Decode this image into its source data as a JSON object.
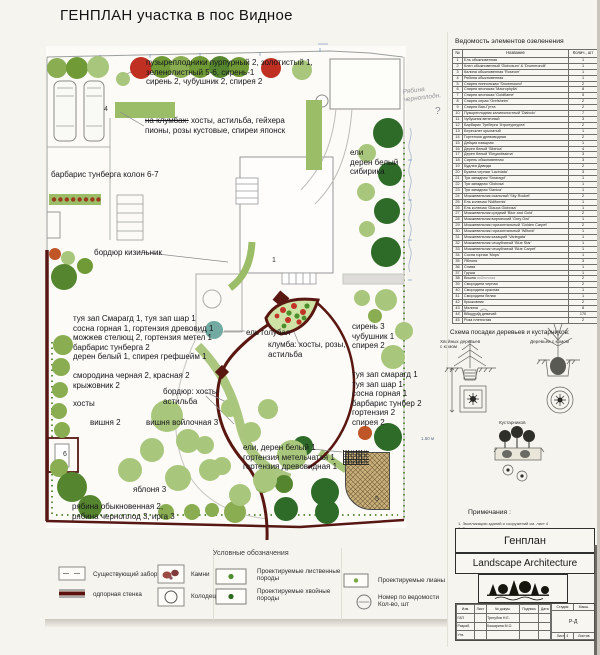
{
  "page": {
    "title": "ГЕНПЛАН участка в пос Видное"
  },
  "plan": {
    "tree_colors": {
      "l": "#a9c77c",
      "m": "#8aad52",
      "g": "#6f9a35",
      "d": "#55862f",
      "e": "#2e6b28",
      "r": "#bf2f22",
      "o": "#c05627",
      "t": "#72aaa2"
    },
    "trees": [
      [
        57,
        68,
        10,
        "m"
      ],
      [
        77,
        68,
        11,
        "g"
      ],
      [
        98,
        67,
        11,
        "l"
      ],
      [
        123,
        79,
        7,
        "l"
      ],
      [
        141,
        68,
        11,
        "r"
      ],
      [
        162,
        67,
        11,
        "g"
      ],
      [
        181,
        67,
        11,
        "m"
      ],
      [
        200,
        67,
        11,
        "g"
      ],
      [
        220,
        67,
        11,
        "d"
      ],
      [
        239,
        67,
        10,
        "g"
      ],
      [
        271,
        68,
        10,
        "r"
      ],
      [
        302,
        70,
        10,
        "l"
      ],
      [
        388,
        133,
        15,
        "e"
      ],
      [
        367,
        153,
        9,
        "l"
      ],
      [
        390,
        174,
        12,
        "e"
      ],
      [
        366,
        192,
        9,
        "l"
      ],
      [
        387,
        211,
        13,
        "e"
      ],
      [
        367,
        229,
        8,
        "l"
      ],
      [
        386,
        252,
        15,
        "e"
      ],
      [
        362,
        298,
        8,
        "l"
      ],
      [
        386,
        300,
        11,
        "l"
      ],
      [
        375,
        316,
        7,
        "m"
      ],
      [
        404,
        331,
        9,
        "l"
      ],
      [
        393,
        357,
        12,
        "l"
      ],
      [
        365,
        433,
        7,
        "o"
      ],
      [
        388,
        437,
        14,
        "e"
      ],
      [
        303,
        446,
        10,
        "e"
      ],
      [
        284,
        484,
        9,
        "d"
      ],
      [
        325,
        492,
        14,
        "e"
      ],
      [
        286,
        509,
        12,
        "e"
      ],
      [
        327,
        512,
        12,
        "e"
      ],
      [
        263,
        485,
        8,
        "m"
      ],
      [
        235,
        512,
        11,
        "m"
      ],
      [
        212,
        510,
        7,
        "m"
      ],
      [
        192,
        512,
        8,
        "m"
      ],
      [
        166,
        512,
        8,
        "m"
      ],
      [
        55,
        254,
        6,
        "o"
      ],
      [
        68,
        258,
        7,
        "l"
      ],
      [
        64,
        277,
        13,
        "d"
      ],
      [
        85,
        266,
        8,
        "g"
      ],
      [
        63,
        345,
        10,
        "m"
      ],
      [
        61,
        367,
        9,
        "m"
      ],
      [
        60,
        390,
        8,
        "m"
      ],
      [
        59,
        411,
        8,
        "m"
      ],
      [
        62,
        430,
        8,
        "m"
      ],
      [
        59,
        468,
        9,
        "m"
      ],
      [
        72,
        487,
        15,
        "d"
      ],
      [
        90,
        507,
        12,
        "d"
      ],
      [
        167,
        416,
        16,
        "l"
      ],
      [
        188,
        441,
        12,
        "l"
      ],
      [
        152,
        450,
        12,
        "l"
      ],
      [
        130,
        470,
        12,
        "l"
      ],
      [
        178,
        478,
        13,
        "l"
      ],
      [
        210,
        470,
        11,
        "l"
      ],
      [
        251,
        432,
        10,
        "l"
      ],
      [
        292,
        455,
        15,
        "l"
      ],
      [
        265,
        480,
        12,
        "l"
      ],
      [
        230,
        408,
        9,
        "l"
      ],
      [
        268,
        409,
        10,
        "l"
      ],
      [
        222,
        466,
        9,
        "l"
      ],
      [
        205,
        445,
        9,
        "l"
      ],
      [
        240,
        495,
        11,
        "l"
      ],
      [
        214,
        330,
        9,
        "t"
      ]
    ],
    "labels": [
      {
        "t": "пузыреплодники пурпурный 2, золотистый 1,\nзеленолистный 5-6, сирень-1\nсирень 2, чубушник 2, спирея 2",
        "x": 146,
        "y": 58
      },
      {
        "pre": "на клумбах:",
        "t": " хосты, астильба, гейхера\nпионы, розы кустовые, спиреи японск",
        "x": 145,
        "y": 116
      },
      {
        "t": "барбарис тунберга колон 6-7",
        "x": 51,
        "y": 170
      },
      {
        "t": "бордюр кизильник",
        "x": 94,
        "y": 248
      },
      {
        "t": "ели\nдерен белый\nсибирика",
        "x": 350,
        "y": 148
      },
      {
        "t": "туя зап Смарагд 1, туя зап шар 1\nсосна горная 1, гортензия древовид 1\nможжев стелющ 2, гортензия метел 1\nбарбарис тунберга 2\nдерен белый 1, спирея грефшейм 1",
        "x": 73,
        "y": 314
      },
      {
        "t": "ель голубая",
        "x": 246,
        "y": 328
      },
      {
        "t": "клумба: хосты, розы,\nастильба",
        "x": 268,
        "y": 340
      },
      {
        "t": "сирень 3\nчубушник 1\nспирея 2",
        "x": 352,
        "y": 322
      },
      {
        "t": "смородина черная 2, красная 2\nкрыжовник 2",
        "x": 73,
        "y": 371
      },
      {
        "t": "бордюр: хосты\nастильба",
        "x": 163,
        "y": 387
      },
      {
        "t": "туя зап смарагд 1\nтуя зап шар 1\nсосна горная 1\nбарбарис тунбер 2\nгортензия 2\nспирея 2",
        "x": 352,
        "y": 370
      },
      {
        "t": "хосты",
        "x": 73,
        "y": 399
      },
      {
        "t": "вишня 2",
        "x": 90,
        "y": 418
      },
      {
        "t": "вишня войлочная 3",
        "x": 146,
        "y": 418
      },
      {
        "t": "ели, дерен белый 1\nгортензия метельчатая 1\nгортензия древовидная 1",
        "x": 243,
        "y": 443
      },
      {
        "t": "яблоня 3",
        "x": 133,
        "y": 485
      },
      {
        "t": "рябина обыкновенная 2,\nрябина черноплод 3, ирга 3",
        "x": 72,
        "y": 502
      }
    ],
    "numbers": [
      [
        "1",
        272,
        257
      ],
      [
        "4",
        104,
        106
      ],
      [
        "5",
        375,
        496
      ],
      [
        "6",
        63,
        451
      ]
    ],
    "pencil_note": "Рябина\nчерноплодн.",
    "question_mark": "?",
    "dim_note": "1.50 м"
  },
  "veg_table": {
    "title": "Ведомость элементов озеленения",
    "columns": [
      "№",
      "Название",
      "Колич., шт"
    ],
    "annotation": {
      "row": 38,
      "text": "войлочная"
    },
    "rows": [
      [
        "1",
        "Ель обыкновенная",
        "1"
      ],
      [
        "2",
        "Клен обыкновенный 'Globosum' & 'Drummondii'",
        "1"
      ],
      [
        "3",
        "Калина обыкновенная 'Roseum'",
        "1"
      ],
      [
        "4",
        "Рябина обыкновенная",
        "1"
      ],
      [
        "5",
        "Спирея ниппонская 'Snowmound'",
        "2"
      ],
      [
        "6",
        "Спирея японская 'Macrophylla'",
        "8"
      ],
      [
        "7",
        "Спирея японская 'Goldflame'",
        "5"
      ],
      [
        "8",
        "Спирея серая 'Grefsheim'",
        "2"
      ],
      [
        "9",
        "Спирея Ван-Гутта",
        "2"
      ],
      [
        "10",
        "Пузыреплодник калинолистный 'Diabolo'",
        "7"
      ],
      [
        "11",
        "Чубушник венечный",
        "3"
      ],
      [
        "12",
        "Барбарис Тунберга 'Атропурпуреа'",
        "2"
      ],
      [
        "13",
        "Бересклет крылатый",
        "1"
      ],
      [
        "14",
        "Гортензия древовидная",
        "2"
      ],
      [
        "15",
        "Дейция изящная",
        "1"
      ],
      [
        "16",
        "Дерен белый 'Sibirica'",
        "4"
      ],
      [
        "17",
        "Дерен белый 'Elegantissima'",
        "3"
      ],
      [
        "18",
        "Сирень обыкновенная",
        "3"
      ],
      [
        "19",
        "Будлея Давида",
        "2"
      ],
      [
        "20",
        "Бузина черная 'Laciniata'",
        "3"
      ],
      [
        "21",
        "Туя западная 'Smaragd'",
        "1"
      ],
      [
        "22",
        "Туя западная 'Globosa'",
        "1"
      ],
      [
        "23",
        "Туя западная 'Danica'",
        "1"
      ],
      [
        "24",
        "Можжевельник скальный 'Sky Rocket'",
        "2"
      ],
      [
        "25",
        "Ель колючая 'Nidiformis'",
        "1"
      ],
      [
        "26",
        "Ель колючая 'Glauca Globosa'",
        "1"
      ],
      [
        "27",
        "Можжевельник средний 'Blue and Gold'",
        "2"
      ],
      [
        "28",
        "Можжевельник виргинский 'Grey Owl'",
        "1"
      ],
      [
        "29",
        "Можжевельник горизонтальный 'Golden Carpet'",
        "2"
      ],
      [
        "30",
        "Можжевельник горизонтальный 'Wiltonii'",
        "1"
      ],
      [
        "31",
        "Можжевельник казацкий 'Variegata'",
        "1"
      ],
      [
        "32",
        "Можжевельник чешуйчатый 'Blue Star'",
        "1"
      ],
      [
        "33",
        "Можжевельник чешуйчатый 'Blue Carpet'",
        "1"
      ],
      [
        "34",
        "Сосна горная 'Mops'",
        "1"
      ],
      [
        "35",
        "Яблоня",
        "3"
      ],
      [
        "36",
        "Слива",
        "1"
      ],
      [
        "37",
        "Груша",
        "1"
      ],
      [
        "38",
        "Вишня",
        "2"
      ],
      [
        "39",
        "Смородина черная",
        "2"
      ],
      [
        "40",
        "Смородина красная",
        "1"
      ],
      [
        "41",
        "Смородина белая",
        "1"
      ],
      [
        "42",
        "Крыжовник",
        "2"
      ],
      [
        "43",
        "Малина",
        "8"
      ],
      [
        "44",
        "Виноград девичий",
        "170"
      ],
      [
        "45",
        "Роза плетистая",
        "2"
      ]
    ]
  },
  "planting_scheme": {
    "title": "Схема посадки деревьев и кустарников:",
    "left_label": "Хвойных деревьев\nс комом",
    "right_label": "Деревьев с комом",
    "middle_label": "Кустарников"
  },
  "notes": {
    "title": "Примечания :",
    "items": [
      "1. Экспликацию зданий и сооружений см. лист 4",
      "2. Все размеры даны в метрах",
      "3. Разбивка элементов озеленения произведена методами перпендикуляров, линейной привязки и радиусных засечек"
    ]
  },
  "title_block": {
    "name": "Генплан",
    "company": "Landscape Architecture",
    "stamp": {
      "headers": [
        "Изм.",
        "Лист",
        "№ докум.",
        "Подпись",
        "Дата"
      ],
      "rows": [
        [
          "ГАП",
          "Трегубов Н.Е."
        ],
        [
          "Разраб.",
          "Кошарина М.О."
        ]
      ],
      "approved_label": "Утв.",
      "stage_label": "Стадия",
      "scale_label": "Масш.",
      "stage": "Р-Д",
      "sheet_label": "Лист",
      "sheet": "4",
      "sheets_label": "Листов"
    }
  },
  "legend": {
    "title": "Условные обозначения",
    "items": [
      {
        "label": "Существующий забор",
        "symbol": "fence"
      },
      {
        "label": "одпорная стенка",
        "symbol": "wall"
      },
      {
        "label": "Камни",
        "symbol": "stones"
      },
      {
        "label": "Колодец",
        "symbol": "well"
      },
      {
        "label": "Проектируемые лиственные\nпороды",
        "symbol": "deciduous"
      },
      {
        "label": "Проектируемые хвойные\nпороды",
        "symbol": "conifer"
      },
      {
        "label": "Проектируемые лианы",
        "symbol": "liana"
      },
      {
        "label": "Номер по ведомости\nКол-во, шт",
        "symbol": "number"
      }
    ]
  }
}
